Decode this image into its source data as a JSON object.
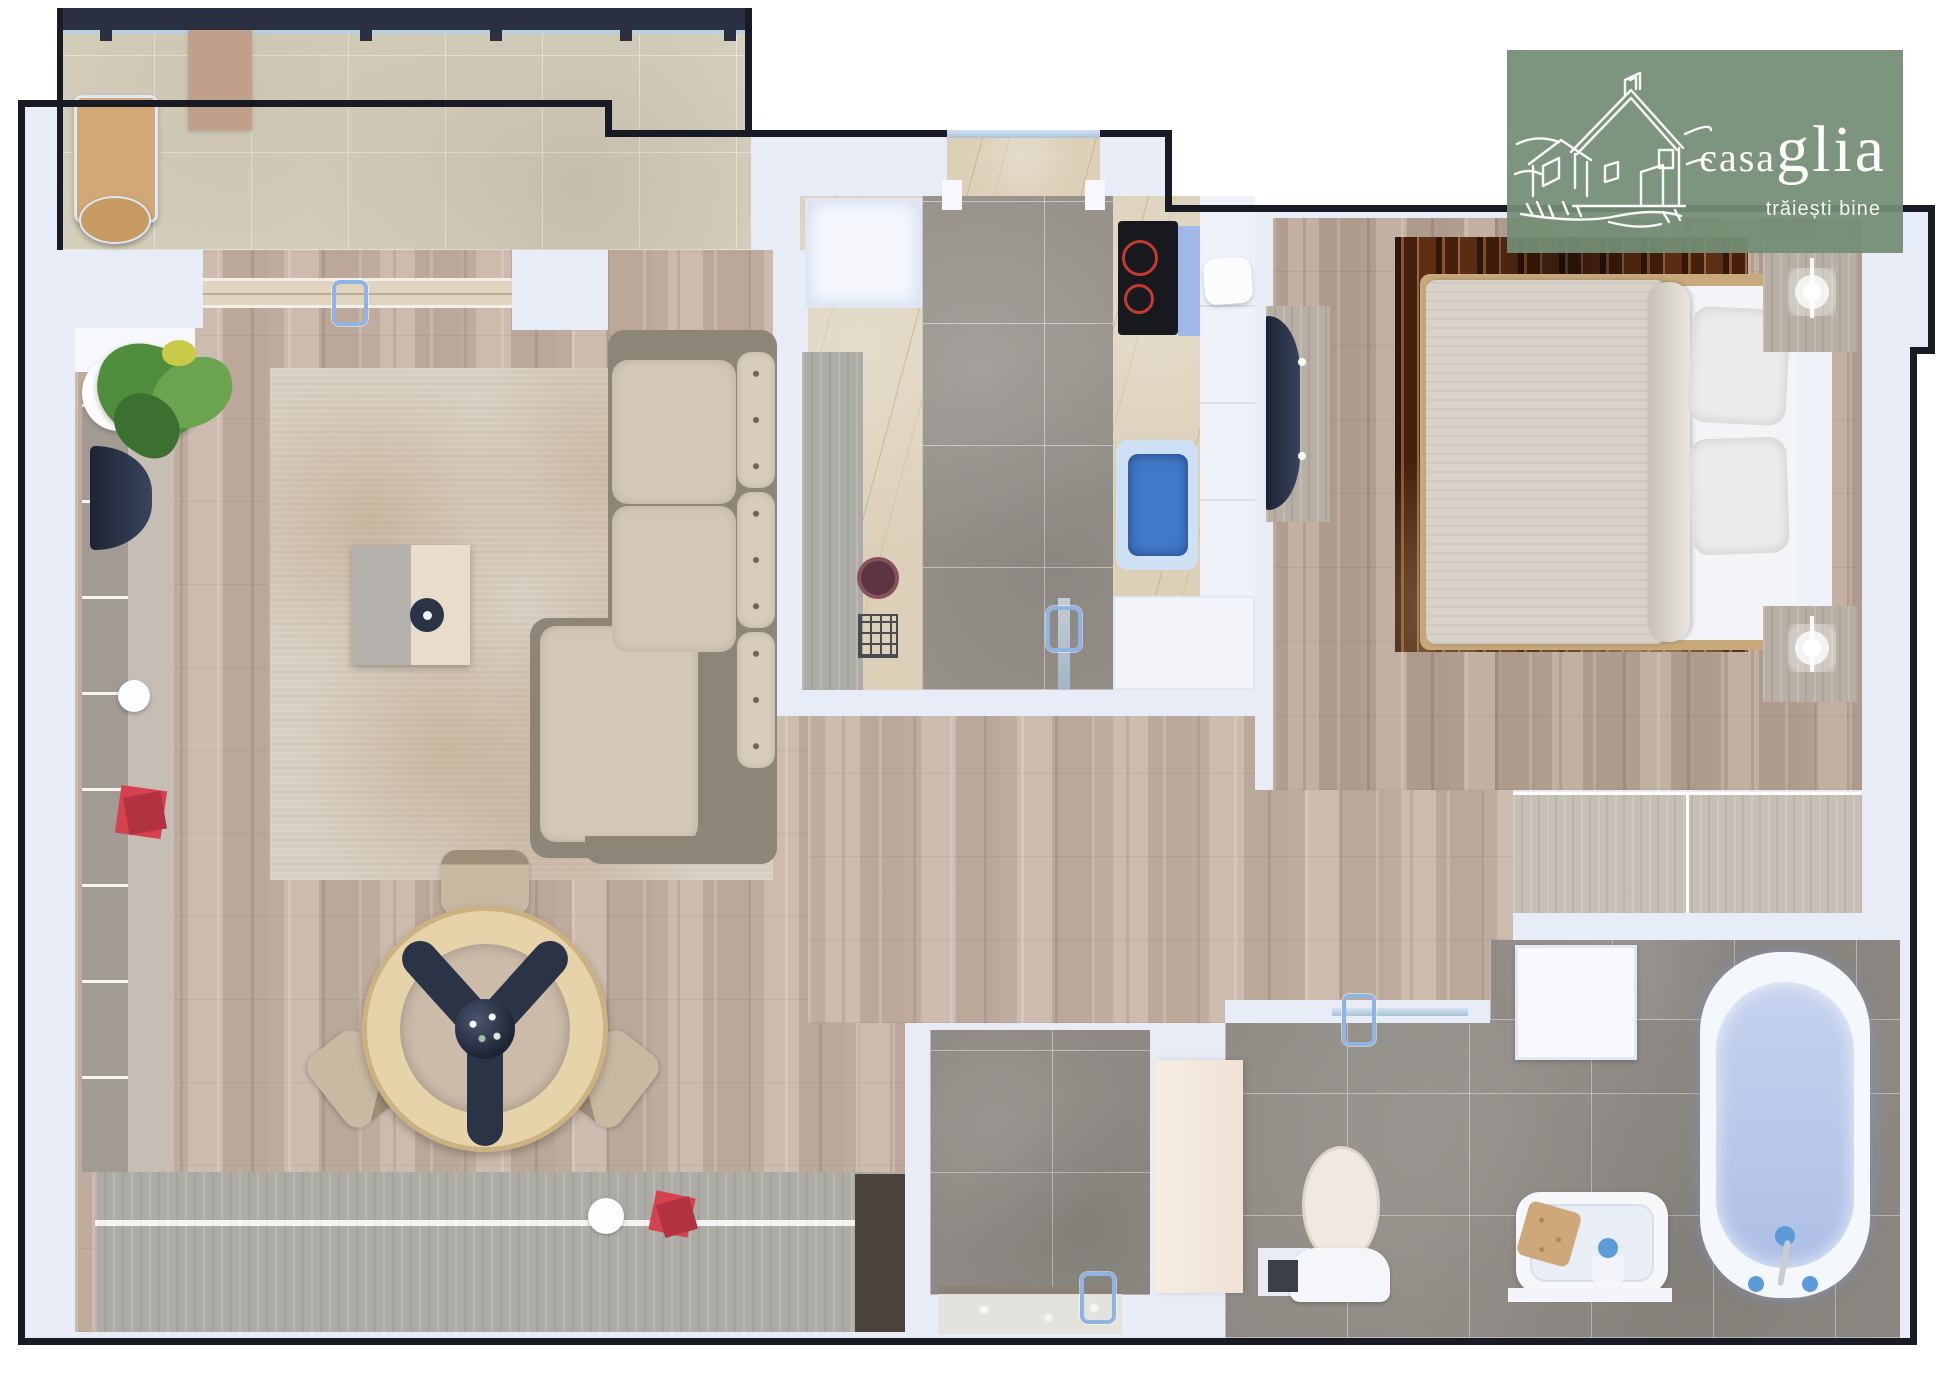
{
  "logo": {
    "brand_casa": "casa",
    "brand_glia": "glia",
    "tagline": "trăiești bine"
  },
  "colors": {
    "wall": "#e7ecf7",
    "outline": "#181b24",
    "rail": "#2a303f",
    "wood": "#c8b6a8",
    "bedroomWood": "#bdab9c",
    "stone": "#d9d3c2",
    "tile": "#97928c",
    "marble": "#dcd0b9",
    "counter": "#adaba6",
    "rug": "#d6cdc0",
    "rugBed": "#5e2e14",
    "sofaFrame": "#8e8579",
    "cushion": "#d3c7b6",
    "navy": "#2b3447",
    "cream": "#f3e9df",
    "fixture": "#f7f9fd",
    "handle": "#8fb4e3",
    "basin": "#4079c9",
    "water": "#b9c6e6",
    "tan": "#d2a877",
    "mat": "#c1a08b",
    "red": "#d6414f",
    "leaf": "#4f8d3c",
    "logoGreen": "#748d75ee",
    "doorWood": "#e0d3bf",
    "cooktop": "#17191f",
    "burner": "#c23b30"
  }
}
